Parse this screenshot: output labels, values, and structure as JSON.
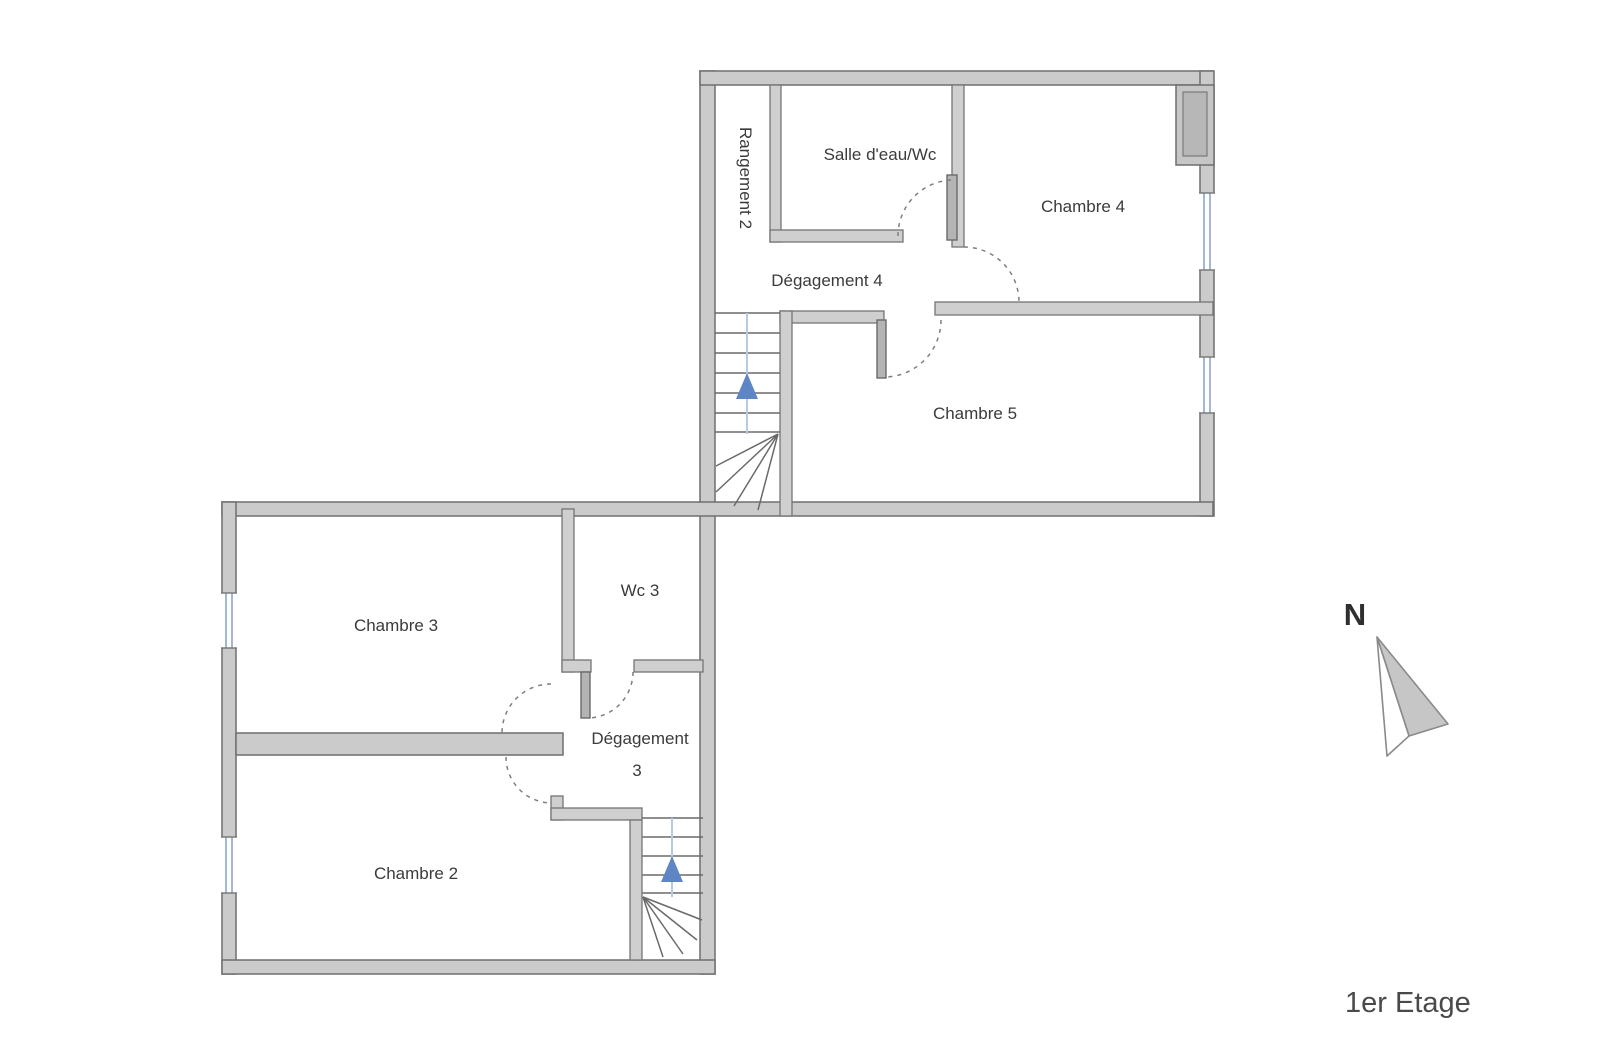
{
  "floor_plan": {
    "title": "1er Etage",
    "compass_letter": "N",
    "rooms": {
      "rangement2": "Rangement 2",
      "salle_eau_wc": "Salle d'eau/Wc",
      "chambre4": "Chambre 4",
      "degagement4": "Dégagement 4",
      "chambre5": "Chambre 5",
      "wc3": "Wc 3",
      "chambre3": "Chambre 3",
      "degagement3_line1": "Dégagement",
      "degagement3_line2": "3",
      "chambre2": "Chambre 2"
    },
    "colors": {
      "wall_fill": "#cbcbcb",
      "wall_stroke": "#6f6f6f",
      "window_blue": "#8ca6cd",
      "stair_arrow_blue": "#5e85c4",
      "door_arc_gray": "#7e7e7e",
      "label_text": "#3b3b3b"
    }
  }
}
